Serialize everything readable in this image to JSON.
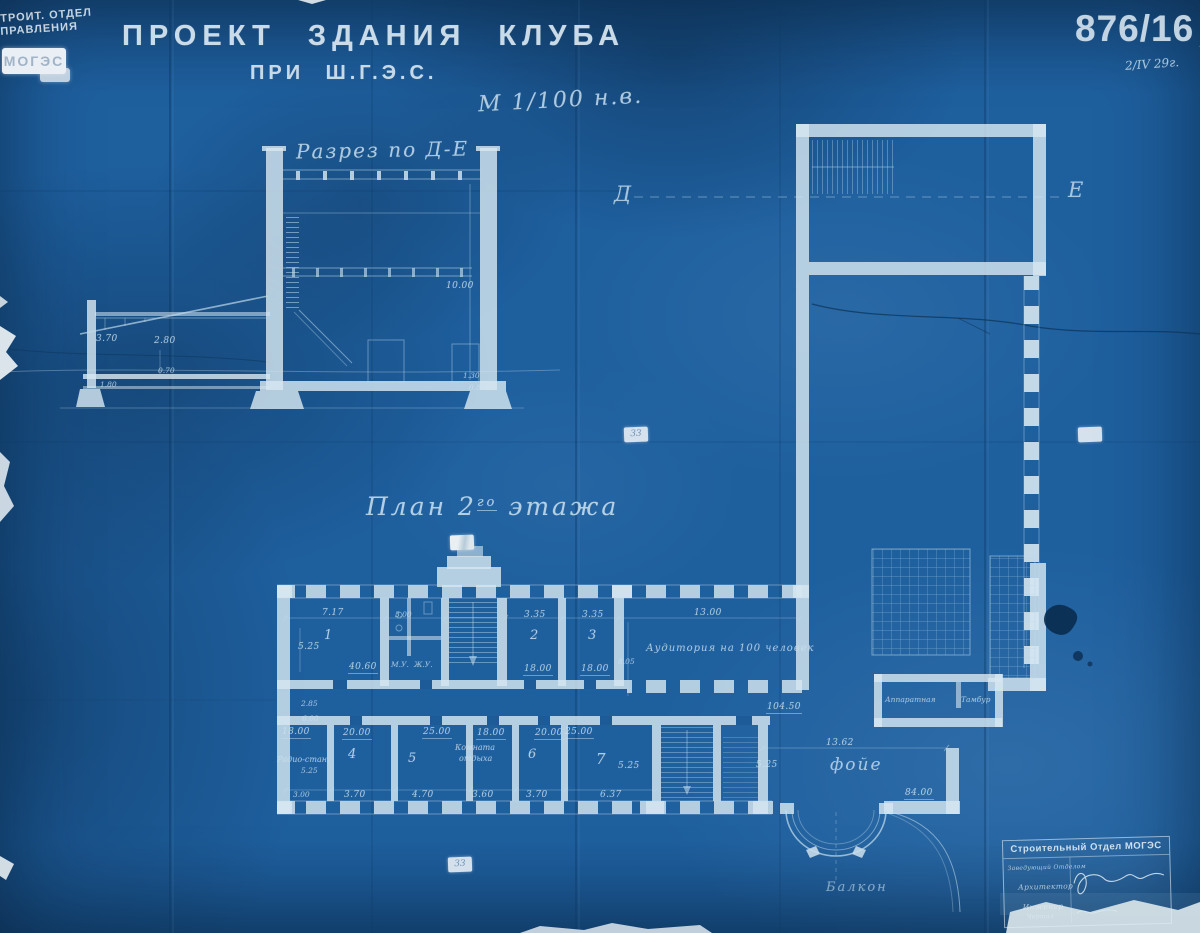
{
  "corner_stamp": {
    "line1": "СТРОИТ. ОТДЕЛ",
    "line2": "УПРАВЛЕНИЯ",
    "logo": "МОГЭС"
  },
  "title_block": {
    "title": "ПРОЕКТ ЗДАНИЯ КЛУБА",
    "subtitle": "ПРИ Ш.Г.Э.С.",
    "scale": "М 1/100 н.в."
  },
  "sheet": {
    "number": "876/16",
    "letter": "А",
    "date": "2/IV 29г."
  },
  "section": {
    "title": "Разрез по Д-Е",
    "dim_left_height": "3.70",
    "dim_annex_width": "2.80",
    "dim_beam": "0.70",
    "dim_floor": "1.80",
    "dim_hall_height": "10.00",
    "dim_base_upper": "1.30",
    "dim_base_lower": "0.80"
  },
  "section_axis": {
    "left": "Д",
    "right": "Е"
  },
  "plan": {
    "title_prefix": "План 2",
    "title_sup": "го",
    "title_suffix": "этажа",
    "rooms_top": [
      {
        "num": "1",
        "width": "7.17",
        "height": "5.25",
        "area": "40.60"
      },
      {
        "num": "2",
        "width": "3.35",
        "area": "18.00"
      },
      {
        "num": "3",
        "width": "3.35",
        "area": "18.00"
      }
    ],
    "toilets": {
      "width": "3.00",
      "label_m": "М.У.",
      "label_j": "Ж.У."
    },
    "auditorium": {
      "label": "Аудитория на 100 человек",
      "width": "13.00",
      "height": "8.05"
    },
    "corridor": {
      "dim": "2.85",
      "dim2": "6.00"
    },
    "radio_room": {
      "label": "Радио-стан.",
      "area": "18.00",
      "height": "5.25",
      "width": "3.00"
    },
    "rooms_bottom": [
      {
        "num": "4",
        "area": "20.00",
        "width": "3.70"
      },
      {
        "num": "5",
        "area": "25.00",
        "width": "4.70"
      },
      {
        "num": "6",
        "area": "20.00",
        "width": "3.70"
      },
      {
        "num": "7",
        "area": "25.00",
        "width": "6.37",
        "height": "5.25"
      }
    ],
    "rest_room": {
      "label_line1": "Комната",
      "label_line2": "отдыха",
      "area": "18.00",
      "width": "3.60"
    },
    "foyer": {
      "label": "фойе",
      "area": "84.00",
      "width": "13.62",
      "height": "5.25",
      "upper_area": "104.50"
    },
    "apparatus_room": "Аппаратная",
    "tambour": "Тамбур",
    "balcony": "Балкон",
    "patch_note": "33"
  },
  "footer_stamp": {
    "header": "Строительный Отдел МОГЭС",
    "row1": "Заведующий Отделом",
    "row2": "Архитектор",
    "row3": "Инженер",
    "row4": "Чертил"
  }
}
